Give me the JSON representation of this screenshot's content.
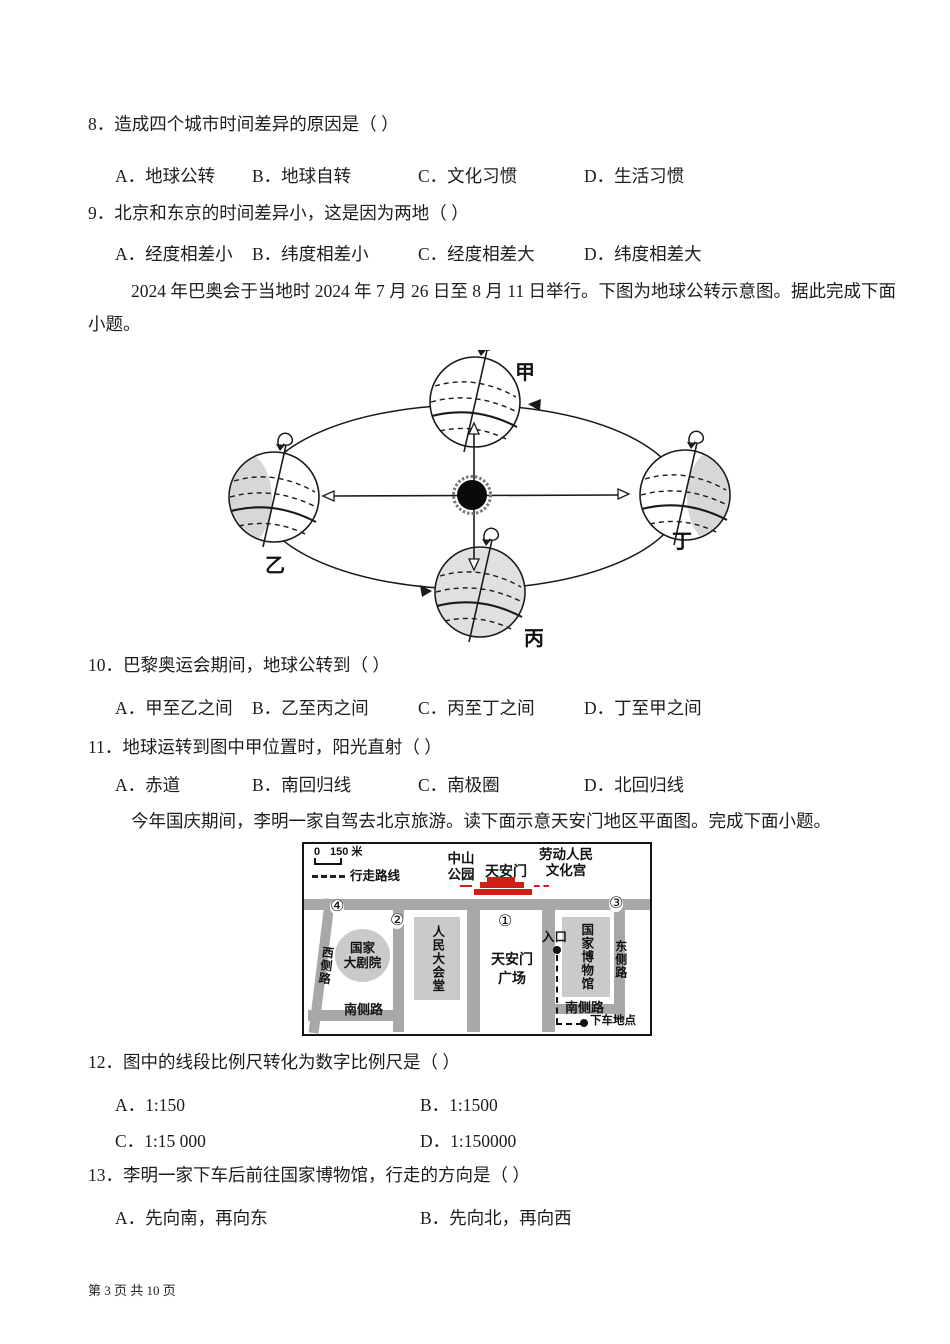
{
  "page": {
    "footer": "第 3 页 共 10 页"
  },
  "questions": {
    "q8": {
      "text": "8．造成四个城市时间差异的原因是（  ）",
      "options": [
        "A．地球公转",
        "B．地球自转",
        "C．文化习惯",
        "D．生活习惯"
      ]
    },
    "q9": {
      "text": "9．北京和东京的时间差异小，这是因为两地（  ）",
      "options": [
        "A．经度相差小",
        "B．纬度相差小",
        "C．经度相差大",
        "D．纬度相差大"
      ]
    },
    "q10": {
      "text": "10．巴黎奥运会期间，地球公转到（  ）",
      "options": [
        "A．甲至乙之间",
        "B．乙至丙之间",
        "C．丙至丁之间",
        "D．丁至甲之间"
      ]
    },
    "q11": {
      "text": "11．地球运转到图中甲位置时，阳光直射（  ）",
      "options": [
        "A．赤道",
        "B．南回归线",
        "C．南极圈",
        "D．北回归线"
      ]
    },
    "q12": {
      "text": "12．图中的线段比例尺转化为数字比例尺是（  ）",
      "options": [
        "A．1:150",
        "B．1:1500",
        "C．1:15 000",
        "D．1:150000"
      ]
    },
    "q13": {
      "text": "13．李明一家下车后前往国家博物馆，行走的方向是（  ）",
      "options": [
        "A．先向南，再向东",
        "B．先向北，再向西"
      ]
    }
  },
  "passages": {
    "olympics_line1": "2024 年巴奥会于当地时 2024 年 7 月 26 日至 8 月 11 日举行。下图为地球公转示意图。据此完成下面",
    "olympics_line2": "小题。",
    "beijing": "今年国庆期间，李明一家自驾去北京旅游。读下面示意天安门地区平面图。完成下面小题。"
  },
  "diagram": {
    "label_jia": "甲",
    "label_yi": "乙",
    "label_bing": "丙",
    "label_ding": "丁"
  },
  "map": {
    "scale_zero": "0",
    "scale_dist": "150 米",
    "legend_route": "行走路线",
    "zhongshan_l1": "中山",
    "zhongshan_l2": "公园",
    "tiananmen": "天安门",
    "laodong_l1": "劳动人民",
    "laodong_l2": "文化宫",
    "num1": "①",
    "num2": "②",
    "num3": "③",
    "num4": "④",
    "west_road": "西侧路",
    "east_road": "东侧路",
    "south_road_left": "南侧路",
    "south_road_right": "南侧路",
    "theater_l1": "国家",
    "theater_l2": "大剧院",
    "hall": "人民大会堂",
    "square_l1": "天安门",
    "square_l2": "广场",
    "museum": "国家博物馆",
    "entrance": "入口",
    "dropoff": "下车地点",
    "colors": {
      "road": "#a8a8a8",
      "building": "#cacaca",
      "gate_red": "#cf1e16"
    }
  }
}
